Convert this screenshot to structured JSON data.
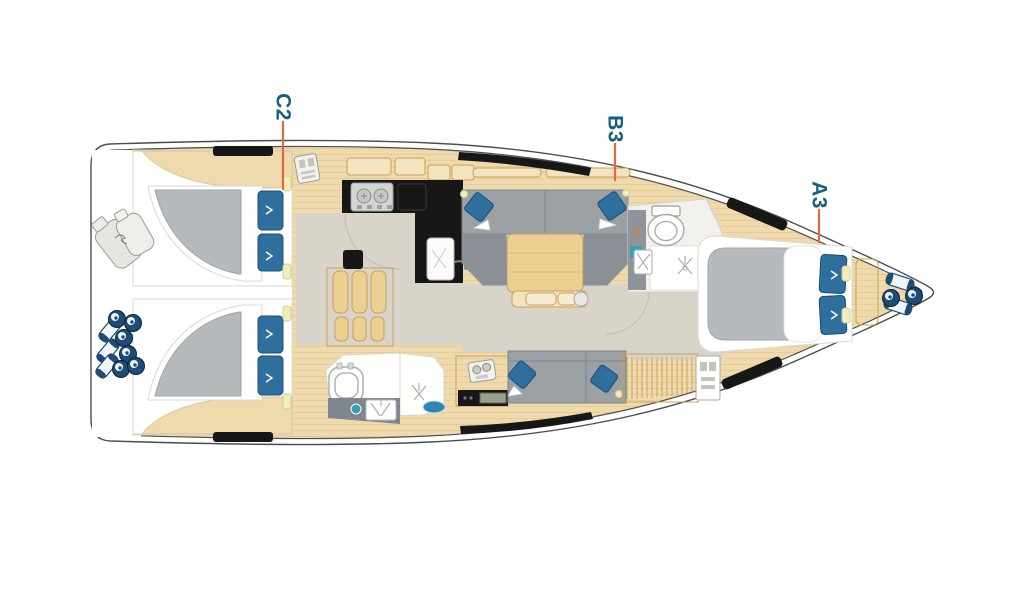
{
  "plan": {
    "labels": [
      {
        "text": "C2"
      },
      {
        "text": "B3"
      },
      {
        "text": "A3"
      }
    ]
  },
  "colors": {
    "hull_line": "#4d4d4d",
    "wood": "#eedaad",
    "wood_edge": "#c9a159",
    "grain": "#e2c68c",
    "sole": "#d8d4ca",
    "room_white": "#ffffff",
    "furniture_gray": "#9aa0a4",
    "furniture_gray_dark": "#8a9096",
    "mattress_gray": "#b6babd",
    "pillow_blue": "#2e6f9e",
    "navy": "#1d4c74",
    "counter_black": "#171717",
    "table_wood": "#ecd093",
    "label_blue": "#19607f",
    "leader_orange": "#e0693f",
    "fixture_line": "#a7aaad",
    "accent_teal": "#35a0bb",
    "accent_yellow": "#f2edbe"
  }
}
